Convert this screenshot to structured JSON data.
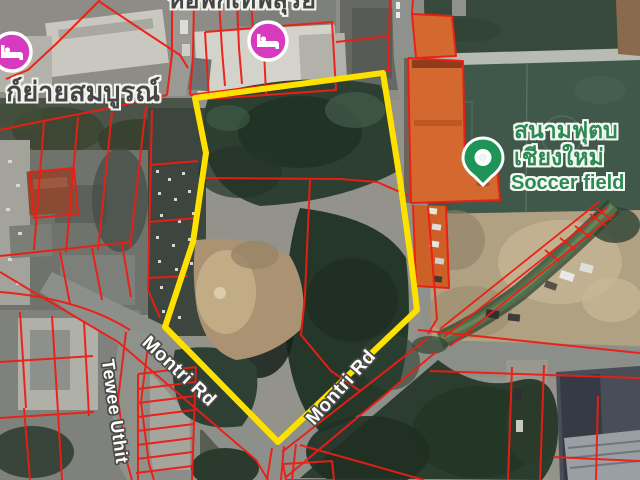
{
  "map": {
    "labels": {
      "top_building": "หอพักเทพสุริย",
      "left_building": "ก์ย่ายสมบูรณ์",
      "soccer_field_th_line1": "สนามฟุตบ",
      "soccer_field_th_line2": "เชียงใหม่",
      "soccer_field_en": "Soccer field",
      "road_montri_left": "Montri Rd",
      "road_montri_right": "Montri Rd",
      "road_tewee": "Tewee Uthit"
    },
    "icons": {
      "lodging_top": "bed-lodging-marker",
      "lodging_left": "bed-lodging-marker",
      "soccer_pin": "soccer-field-pin"
    },
    "colors": {
      "parcel_highlight": "#ffe100",
      "cadastral_line": "#ee1d13",
      "soccer_field_green": "#3f584a",
      "poi_label_green": "#2e8a54",
      "lodging_pink": "#d63bbf",
      "pin_green": "#1f9458"
    }
  }
}
